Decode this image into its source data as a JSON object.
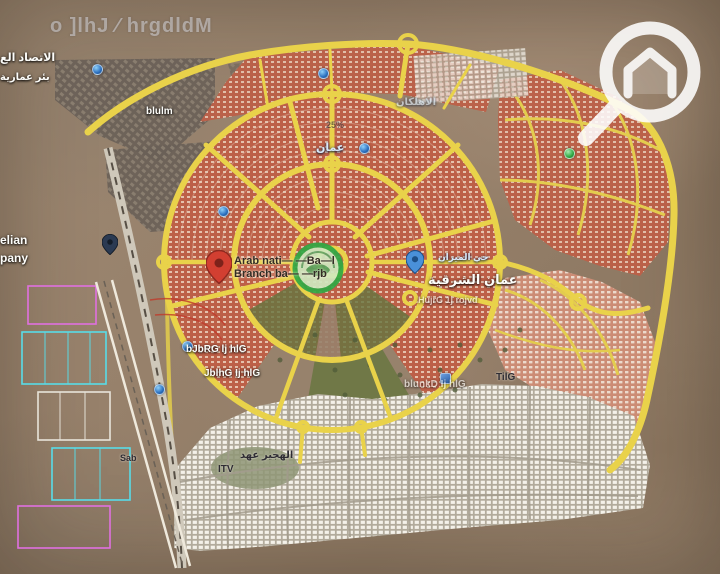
{
  "watermark": "o ]lhJ ⁄ hrgdldM",
  "labels": {
    "ittisad": "الاتصاد الع",
    "bir_amaria": "بئر عمارية",
    "blulm": "blulm",
    "pct": "25%",
    "oman": "عمان",
    "ahlkan": "الاهلكان",
    "hay_mizan": "حي الميزان",
    "sharqiya": "عمان الشرقية",
    "hujrg": "HujrG 1j rojvd",
    "elian": "elian",
    "pany": "pany",
    "bjbrg": "bJbRG lj hlG",
    "jblhg": "JblhG Ij hlG",
    "blunkd": "blunkD Ij hlG",
    "tilg": "TilG",
    "hajir": "الهجير عهد",
    "itv": "ITV",
    "sab": "Sab"
  },
  "pin_label": {
    "line1": "Arab nati— —Ba—l",
    "line2": "Branch ba— —rjb"
  },
  "icons": {
    "red_pin": "map-pin",
    "blue_pin": "map-pin",
    "dark_pin": "map-pin",
    "poi_dot": "poi-circle",
    "business_logo": "green-circle-logo",
    "brand_logo": "magnifier-house-logo"
  },
  "palette": {
    "road_yellow": "#e9d24a",
    "district_orange": "#bd6048",
    "district_white": "#f4f1e9",
    "district_pink": "#cf8d76",
    "desert": "#97826c",
    "park_green": "#67753f",
    "cad_cyan": "#58dce8",
    "cad_magenta": "#e070e0",
    "pin_red": "#d23f31",
    "poi_blue": "#2a6fc0",
    "logo_green": "#2fa944"
  }
}
